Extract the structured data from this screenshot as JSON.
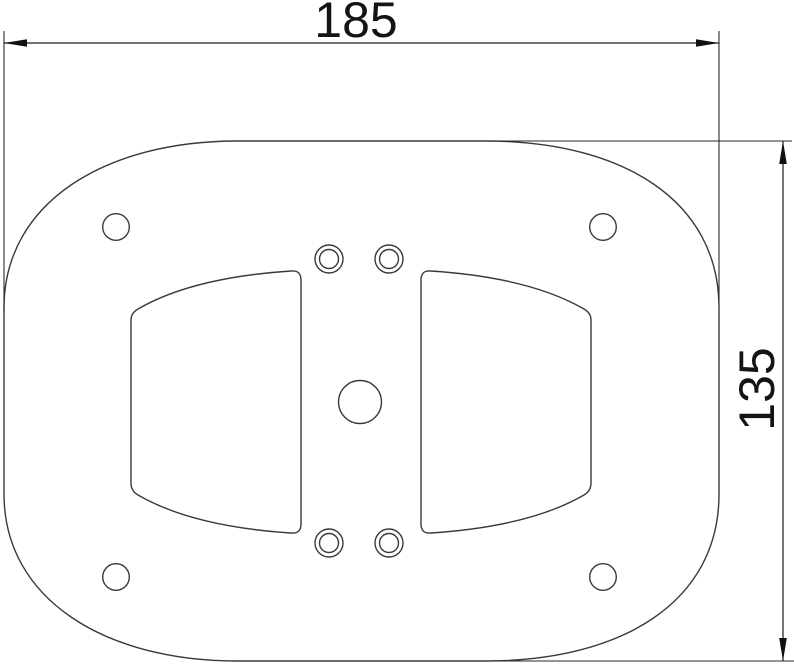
{
  "drawing": {
    "kind": "technical-dimension-drawing",
    "width_dimension": {
      "label": "185"
    },
    "height_dimension": {
      "label": "135"
    }
  },
  "style": {
    "background_color": "#ffffff",
    "outline_color": "#3a3a3a",
    "dimension_color": "#1c1c1c"
  },
  "features": {
    "corner_holes": 4,
    "double_ring_holes": 4,
    "center_hole": 1,
    "cutouts": 2
  }
}
